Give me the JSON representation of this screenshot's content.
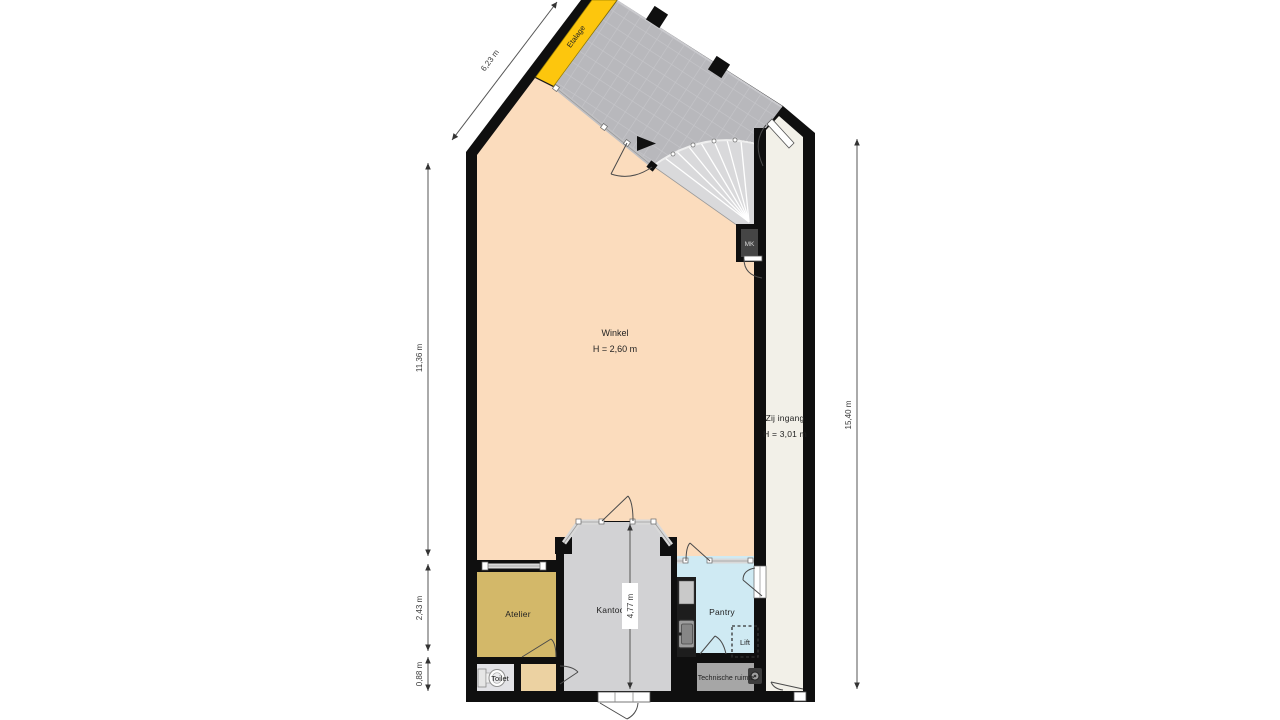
{
  "labels": {
    "etalage": "Etalage",
    "winkel": "Winkel",
    "winkel_height": "H = 2,60 m",
    "zij_ingang": "Zij ingang",
    "zij_ingang_height": "H = 3,01 m",
    "atelier": "Atelier",
    "kantoor": "Kantoor",
    "pantry": "Pantry",
    "lift": "Lift",
    "toilet": "Toilet",
    "technische_ruimte": "Technische ruimte",
    "mk": "MK"
  },
  "dimensions": {
    "storefront": "6,23 m",
    "left_upper": "11,36 m",
    "left_middle": "2,43 m",
    "left_lower": "0,88 m",
    "right_side": "15,40 m",
    "kantoor_depth": "4,77 m"
  },
  "colors": {
    "wall": "#0f0f0f",
    "winkel_floor": "#fbdcbd",
    "etalage_strip": "#fdc60d",
    "entrance_tiles": "#b8b8bc",
    "corridor_floor": "#f2f0e8",
    "atelier_floor": "#d3b869",
    "kantoor_floor": "#d2d2d4",
    "pantry_floor": "#cfeaf3",
    "vestibule_floor": "#ecd2a2",
    "toilet_floor": "#e2e2e6",
    "technical_floor": "#a6a6a6",
    "stair_fill": "#d9d9db",
    "counter": "#1d1d1d"
  }
}
